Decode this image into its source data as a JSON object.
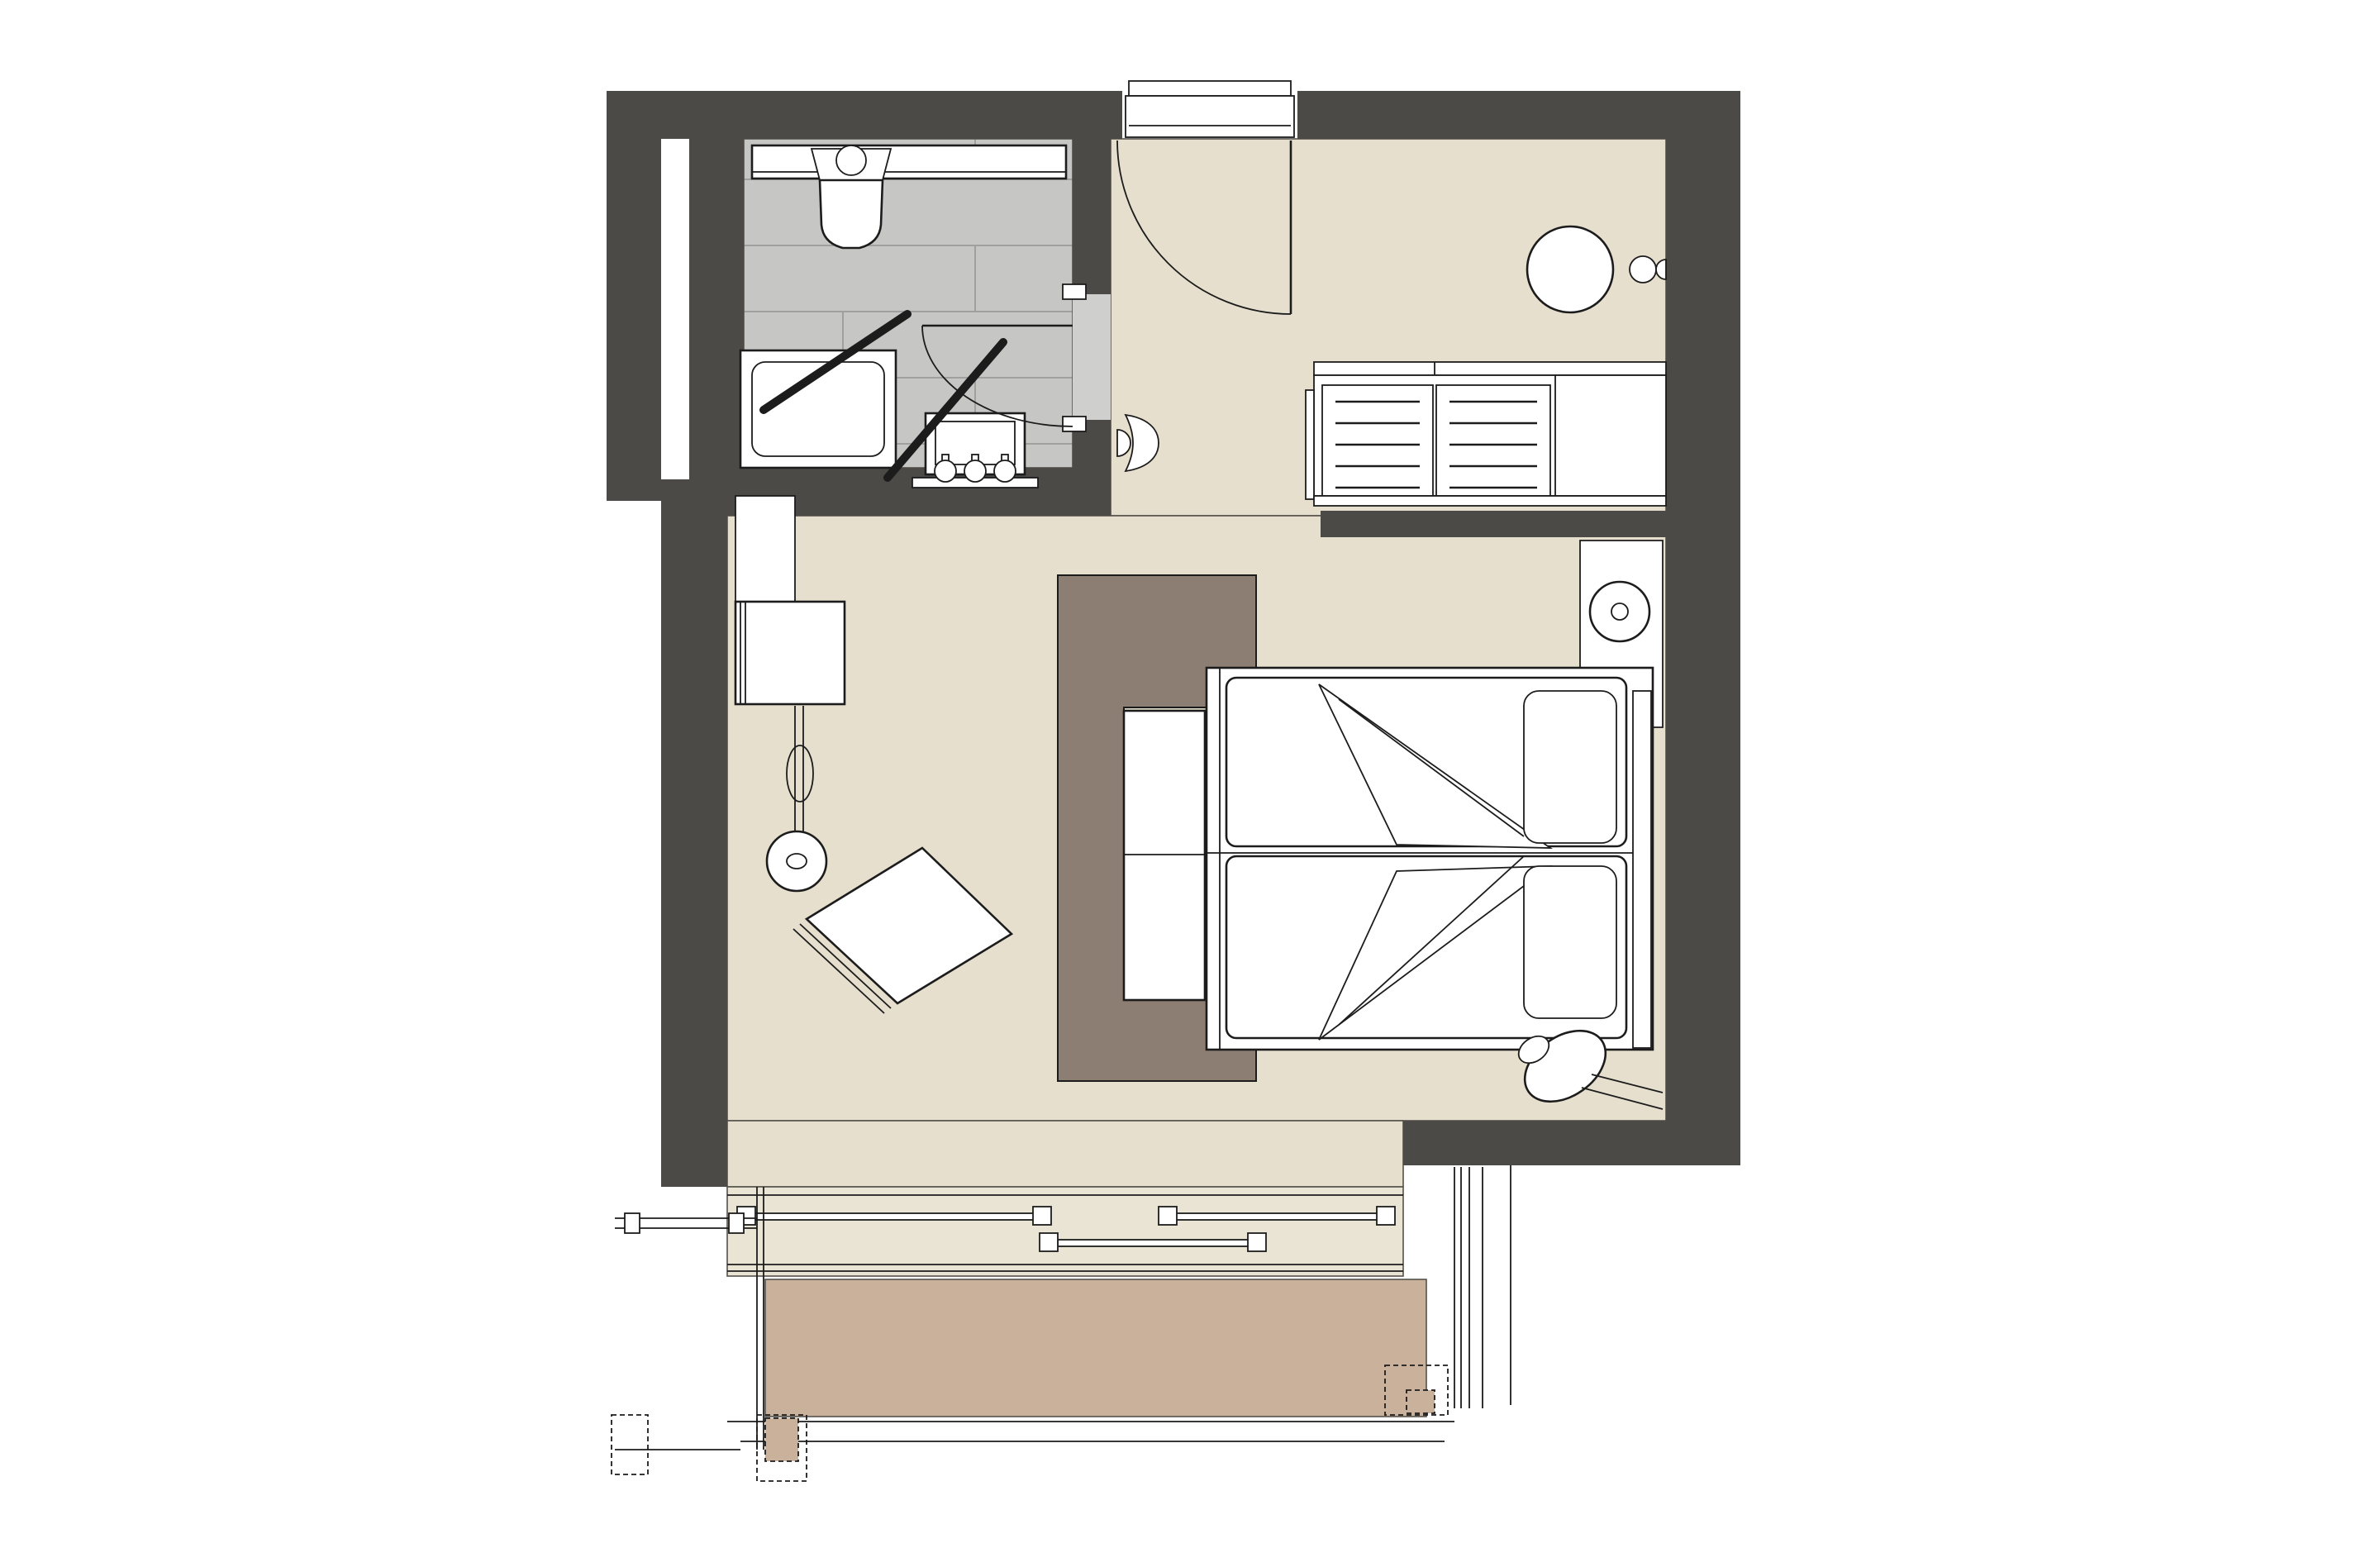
{
  "plan": {
    "type": "hotel-room-floor-plan",
    "colors": {
      "wall": "#4b4a47",
      "floor": "#e6dfcd",
      "window_band": "#eae4d4",
      "balcony": "#c9b19b",
      "tile": "#c6c6c5",
      "grout": "#a0a09e",
      "furniture_brown": "#8c7e73",
      "line": "#1c1c1c",
      "outline": "#55524c",
      "paper": "#ffffff"
    },
    "rooms": [
      {
        "id": "bathroom",
        "floor_finish": "grey-tile",
        "fixtures": [
          "wall-hung-toilet",
          "cistern-shelf",
          "shower-tray",
          "vanity-basin-with-taps",
          "glass-screen-lines",
          "inward-swing-door",
          "corner-wall-sconce"
        ]
      },
      {
        "id": "entry",
        "floor_finish": "beige",
        "fixtures": [
          "entry-door-with-threshold",
          "round-stool",
          "wall-sconce"
        ]
      },
      {
        "id": "bedroom",
        "floor_finish": "beige",
        "fixtures": [
          "double-bed-two-mattresses",
          "two-pillows",
          "two-folded-duvets",
          "headboard-panel",
          "nightstand",
          "table-lamp",
          "arc-floor-lamp",
          "foot-bench-brown-surround",
          "bench-cushions",
          "wall-desk",
          "desk-floor-lamp",
          "diagonal-armchair",
          "wardrobe-two-slatted-doors",
          "open-shelf-compartment"
        ]
      },
      {
        "id": "balcony",
        "floor_finish": "tan-decking",
        "fixtures": [
          "sliding-glass-wall-three-panels",
          "glass-railing",
          "corner-posts",
          "neighbour-balcony-divider",
          "privacy-screen-lines"
        ]
      }
    ]
  }
}
